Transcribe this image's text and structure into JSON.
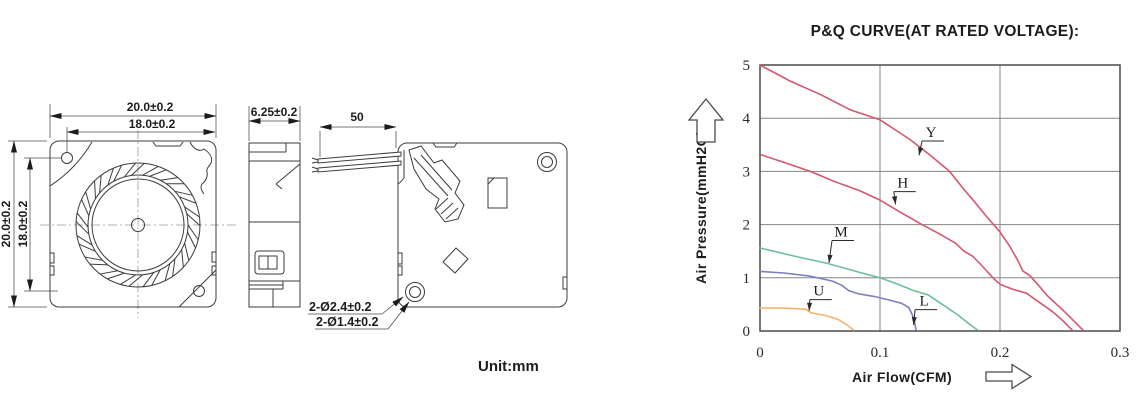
{
  "drawing": {
    "front_view": {
      "dim_width_outer": "20.0±0.2",
      "dim_width_inner": "18.0±0.2",
      "dim_height_outer": "20.0±0.2",
      "dim_height_inner": "18.0±0.2"
    },
    "side_view": {
      "dim_thickness": "6.25±0.2"
    },
    "back_view": {
      "dim_wire_length": "50",
      "dim_hole_outer": "2-Ø2.4±0.2",
      "dim_hole_inner": "2-Ø1.4±0.2"
    },
    "unit_label": "Unit:mm"
  },
  "chart": {
    "title": "P&Q CURVE(AT RATED VOLTAGE):",
    "ylabel": "Air Pressure(mmH2O)",
    "xlabel": "Air Flow(CFM)"
  },
  "chart_data": {
    "type": "line",
    "title": "P&Q CURVE(AT RATED VOLTAGE):",
    "xlabel": "Air Flow(CFM)",
    "ylabel": "Air Pressure(mmH2O)",
    "xlim": [
      0,
      0.3
    ],
    "ylim": [
      0,
      5
    ],
    "xticks": [
      0,
      0.1,
      0.2,
      0.3
    ],
    "yticks": [
      0,
      1,
      2,
      3,
      4,
      5
    ],
    "grid": true,
    "legend": "inline-labels",
    "series": [
      {
        "name": "Y",
        "color": "#d6576f",
        "label_at": [
          0.1425,
          3.74
        ],
        "arrow_tip": [
          0.1325,
          3.3
        ],
        "points": [
          [
            0,
            5.0
          ],
          [
            0.025,
            4.7
          ],
          [
            0.05,
            4.45
          ],
          [
            0.075,
            4.16
          ],
          [
            0.1,
            3.97
          ],
          [
            0.125,
            3.6
          ],
          [
            0.142,
            3.3
          ],
          [
            0.158,
            3.0
          ],
          [
            0.17,
            2.66
          ],
          [
            0.178,
            2.45
          ],
          [
            0.19,
            2.12
          ],
          [
            0.2,
            1.86
          ],
          [
            0.208,
            1.6
          ],
          [
            0.215,
            1.32
          ],
          [
            0.219,
            1.13
          ],
          [
            0.225,
            1.04
          ],
          [
            0.232,
            0.86
          ],
          [
            0.24,
            0.65
          ],
          [
            0.253,
            0.38
          ],
          [
            0.262,
            0.18
          ],
          [
            0.269,
            0.02
          ]
        ]
      },
      {
        "name": "H",
        "color": "#d6576f",
        "label_at": [
          0.119,
          2.79
        ],
        "arrow_tip": [
          0.113,
          2.38
        ],
        "points": [
          [
            0,
            3.32
          ],
          [
            0.02,
            3.17
          ],
          [
            0.042,
            3.0
          ],
          [
            0.062,
            2.81
          ],
          [
            0.083,
            2.64
          ],
          [
            0.1,
            2.46
          ],
          [
            0.118,
            2.22
          ],
          [
            0.135,
            2.0
          ],
          [
            0.15,
            1.82
          ],
          [
            0.163,
            1.65
          ],
          [
            0.17,
            1.5
          ],
          [
            0.177,
            1.41
          ],
          [
            0.184,
            1.25
          ],
          [
            0.195,
            0.98
          ],
          [
            0.2,
            0.88
          ],
          [
            0.21,
            0.79
          ],
          [
            0.222,
            0.71
          ],
          [
            0.232,
            0.55
          ],
          [
            0.244,
            0.36
          ],
          [
            0.253,
            0.18
          ],
          [
            0.26,
            0.02
          ]
        ]
      },
      {
        "name": "M",
        "color": "#6fbe9b",
        "label_at": [
          0.0675,
          1.87
        ],
        "arrow_tip": [
          0.0575,
          1.28
        ],
        "points": [
          [
            0,
            1.56
          ],
          [
            0.03,
            1.4
          ],
          [
            0.056,
            1.27
          ],
          [
            0.085,
            1.09
          ],
          [
            0.1,
            1.0
          ],
          [
            0.115,
            0.88
          ],
          [
            0.128,
            0.76
          ],
          [
            0.14,
            0.68
          ],
          [
            0.152,
            0.5
          ],
          [
            0.165,
            0.3
          ],
          [
            0.175,
            0.12
          ],
          [
            0.181,
            0.02
          ]
        ]
      },
      {
        "name": "L",
        "color": "#7d80ba",
        "label_at": [
          0.1367,
          0.57
        ],
        "arrow_tip": [
          0.128,
          0.11
        ],
        "points": [
          [
            0,
            1.12
          ],
          [
            0.02,
            1.09
          ],
          [
            0.042,
            1.03
          ],
          [
            0.06,
            0.94
          ],
          [
            0.068,
            0.86
          ],
          [
            0.074,
            0.76
          ],
          [
            0.082,
            0.7
          ],
          [
            0.095,
            0.65
          ],
          [
            0.108,
            0.58
          ],
          [
            0.118,
            0.52
          ],
          [
            0.124,
            0.44
          ],
          [
            0.127,
            0.3
          ],
          [
            0.129,
            0.15
          ],
          [
            0.13,
            0.02
          ]
        ]
      },
      {
        "name": "U",
        "color": "#f3b470",
        "label_at": [
          0.049,
          0.76
        ],
        "arrow_tip": [
          0.041,
          0.38
        ],
        "points": [
          [
            0,
            0.43
          ],
          [
            0.02,
            0.43
          ],
          [
            0.038,
            0.41
          ],
          [
            0.043,
            0.34
          ],
          [
            0.055,
            0.29
          ],
          [
            0.065,
            0.22
          ],
          [
            0.072,
            0.12
          ],
          [
            0.078,
            0.02
          ]
        ]
      }
    ]
  }
}
